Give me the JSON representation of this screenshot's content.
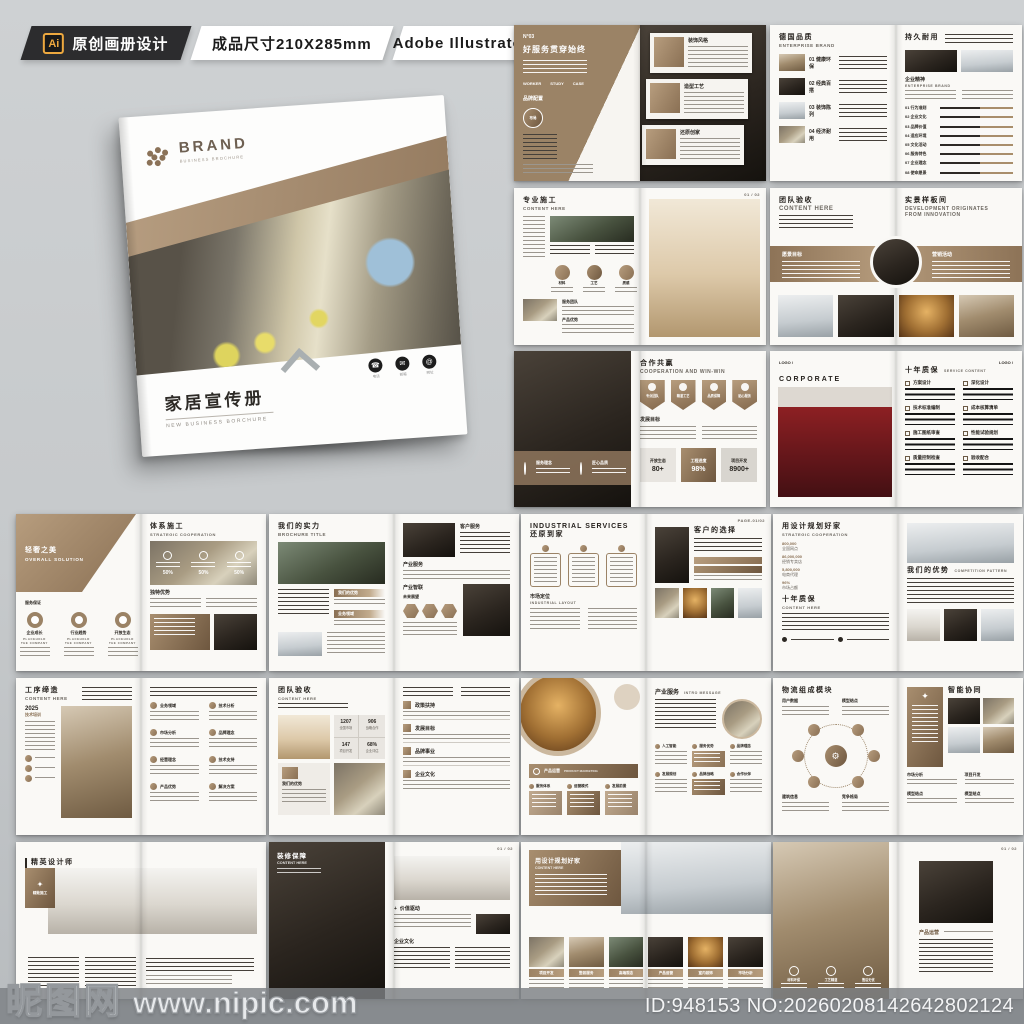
{
  "meta_bar": {
    "ai_badge": "Ai",
    "tag_original": "原创画册设计",
    "tag_size": "成品尺寸210X285mm",
    "tag_software": "Adobe Illustrator CC 2018"
  },
  "cover": {
    "brand": "BRAND",
    "brand_sub": "BUSINESS BROCHURE",
    "title": "家居宣传册",
    "subtitle": "NEW BUSINESS BORCHURE",
    "contacts": [
      "电话",
      "邮箱",
      "网址"
    ]
  },
  "icons": {
    "phone": "☎",
    "mail": "✉",
    "web": "@",
    "gear": "⚙",
    "star": "✦"
  },
  "colors": {
    "accent_brown": "#a1886a",
    "dark_bar": "#2c2c2e",
    "ai_orange": "#eda83f",
    "background": "#c7cacc"
  },
  "spreads": [
    {
      "no": "N°03",
      "title": "好服务贯穿始终",
      "words": [
        "WORKER",
        "STUDY",
        "CASE"
      ],
      "tag": "品牌配置",
      "badge": "布局",
      "cards": [
        "装饰风格",
        "造型工艺",
        "还原创家"
      ]
    },
    {
      "title_left": "德国品质",
      "sub_left": "ENTERPRISE BRAND",
      "items": [
        "01 健康环保",
        "02 经典百搭",
        "03 装饰陈列",
        "04 经济耐用"
      ],
      "title_right": "持久耐用",
      "section_right": "企业精神",
      "sub_section": "ENTERPRISE BRAND",
      "bars": [
        "01 行为准则",
        "02 企业文化",
        "03 品牌价值",
        "04 适应环境",
        "05 文化活动",
        "06 服务特色",
        "07 企业理念",
        "08 使命愿景"
      ]
    },
    {
      "title": "专业施工",
      "sub": "CONTENT HERE",
      "section1": "服务团队",
      "circles": [
        "材料",
        "工艺",
        "质感"
      ],
      "section2": "产品优势",
      "page_no": "01 / 02"
    },
    {
      "title_left": "团队验收",
      "sub_left": "CONTENT HERE",
      "band_left": "愿景目标",
      "band_right": "营销活动",
      "title_right": "实景样板间",
      "sub_right1": "DEVELOPMENT ORIGINATES",
      "sub_right2": "FROM INNOVATION"
    },
    {
      "overlay1": "服务理念",
      "overlay2": "匠心品质",
      "title": "合作共赢",
      "sub": "COOPERATION AND WIN-WIN",
      "badges": [
        "专业团队",
        "精湛工艺",
        "品质保障",
        "贴心服务"
      ],
      "section": "发展目标",
      "stats": [
        {
          "label": "开放生态",
          "value": "80+"
        },
        {
          "label": "工程进度",
          "value": "98%"
        },
        {
          "label": "项目开发",
          "value": "8900+"
        }
      ]
    },
    {
      "logo": "LOGO /",
      "title_en": "CORPORATE CULTURE",
      "title_cn": "大宅设计",
      "title_right": "十年质保",
      "sub_right": "SERVICE CONTENT",
      "services": [
        "方案设计",
        "深化设计",
        "技术标准编制",
        "成本核算清单",
        "施工图纸审查",
        "性能试验规划",
        "质量控制检查",
        "验收配合"
      ]
    },
    {
      "title_left": "轻奢之美",
      "sub_left": "OVERALL SOLUTION",
      "section_left": "服务保证",
      "donuts": [
        "企业成长",
        "行业趋势",
        "开放生态"
      ],
      "donut_sub": "PLACEHOLD THE COMPANY",
      "title_right": "体系施工",
      "sub_right": "STRATEGIC COOPERATION",
      "pct": "50%",
      "section_right": "独特优势"
    },
    {
      "title": "我们的实力",
      "sub": "BROCHURE TITLE",
      "tags": [
        "我们的优势",
        "业务领域"
      ],
      "labels_right": [
        "客户服务",
        "产业服务",
        "产业智联",
        "未来展望"
      ]
    },
    {
      "title_en": "INDUSTRIAL SERVICES",
      "title_cn": "还原到家",
      "section": "市场定位",
      "section_sub": "INDUSTRIAL LAYOUT",
      "title_right": "客户的选择",
      "page_no": "PAGE-01/02"
    },
    {
      "title_left": "用设计规划好家",
      "sub_left": "STRATEGIC COOPERATION",
      "stats": [
        {
          "value": "800,000",
          "label": "全国网点"
        },
        {
          "value": "86,000,000",
          "label": "经销专卖店"
        },
        {
          "value": "5,800,000",
          "label": "电商代理"
        },
        {
          "value": "96%",
          "label": "市场占额"
        }
      ],
      "section": "十年质保",
      "section_sub": "CONTENT HERE",
      "title_right": "我们的优势",
      "sub_right": "COMPETITION PATTERN"
    },
    {
      "title": "工序缔造",
      "sub": "CONTENT HERE",
      "year": "2025",
      "year_label": "技术培训",
      "items": [
        "业务领域",
        "技术分析",
        "市场分析",
        "品牌理念",
        "经营理念",
        "技术支持",
        "产品优势",
        "解决方案"
      ]
    },
    {
      "title": "团队验收",
      "sub": "CONTENT HERE",
      "stats": [
        {
          "value": "1207",
          "label": "全国市场"
        },
        {
          "value": "906",
          "label": "战略合作"
        },
        {
          "value": "147",
          "label": "项目开发"
        },
        {
          "value": "68%",
          "label": "企业评估"
        }
      ],
      "box_label": "我们的优势",
      "sections": [
        "政策扶持",
        "发展目标",
        "品牌事业",
        "企业文化"
      ]
    },
    {
      "bar_label": "产品运营",
      "bar_sub": "PRODUCT MARKETING",
      "flow_left": [
        "服务体系",
        "运营模式",
        "发展前景"
      ],
      "title_right": "产业服务",
      "sub_right": "INTRO MESSAGE",
      "flow_right": [
        "人工智能",
        "服务优势",
        "品牌理念",
        "发展规划",
        "品牌战略",
        "合作伙伴"
      ]
    },
    {
      "title_left": "物流组成模块",
      "corners": [
        "用户数据",
        "模型结点",
        "建筑信息",
        "竞争格局"
      ],
      "title_right": "智能协同",
      "labels_right": [
        "市场分析",
        "项目开发",
        "模型结点",
        "模型结点"
      ]
    },
    {
      "title": "精英设计师",
      "sub": "SUCCESSFUL CASES",
      "badge": "精致施工"
    },
    {
      "title_left": "装修保障",
      "sub_left": "CONTENT HERE",
      "page_no": "01 / 02",
      "section1": "价值驱动",
      "section2": "企业文化"
    },
    {
      "title": "用设计规划好家",
      "sub": "CONTENT HERE",
      "cards": [
        "项目开发",
        "整装服务",
        "高端观念",
        "产品运营",
        "室内装饰",
        "市场分析"
      ]
    },
    {
      "page_no": "01 / 02",
      "title": "产品运营",
      "icons_labels": [
        "材料环保",
        "工艺精湛",
        "售后无忧"
      ]
    }
  ],
  "footer": {
    "site_name": "昵图网",
    "site_url": "www.nipic.com",
    "image_id": "ID:948153 NO:20260208142642802124"
  }
}
